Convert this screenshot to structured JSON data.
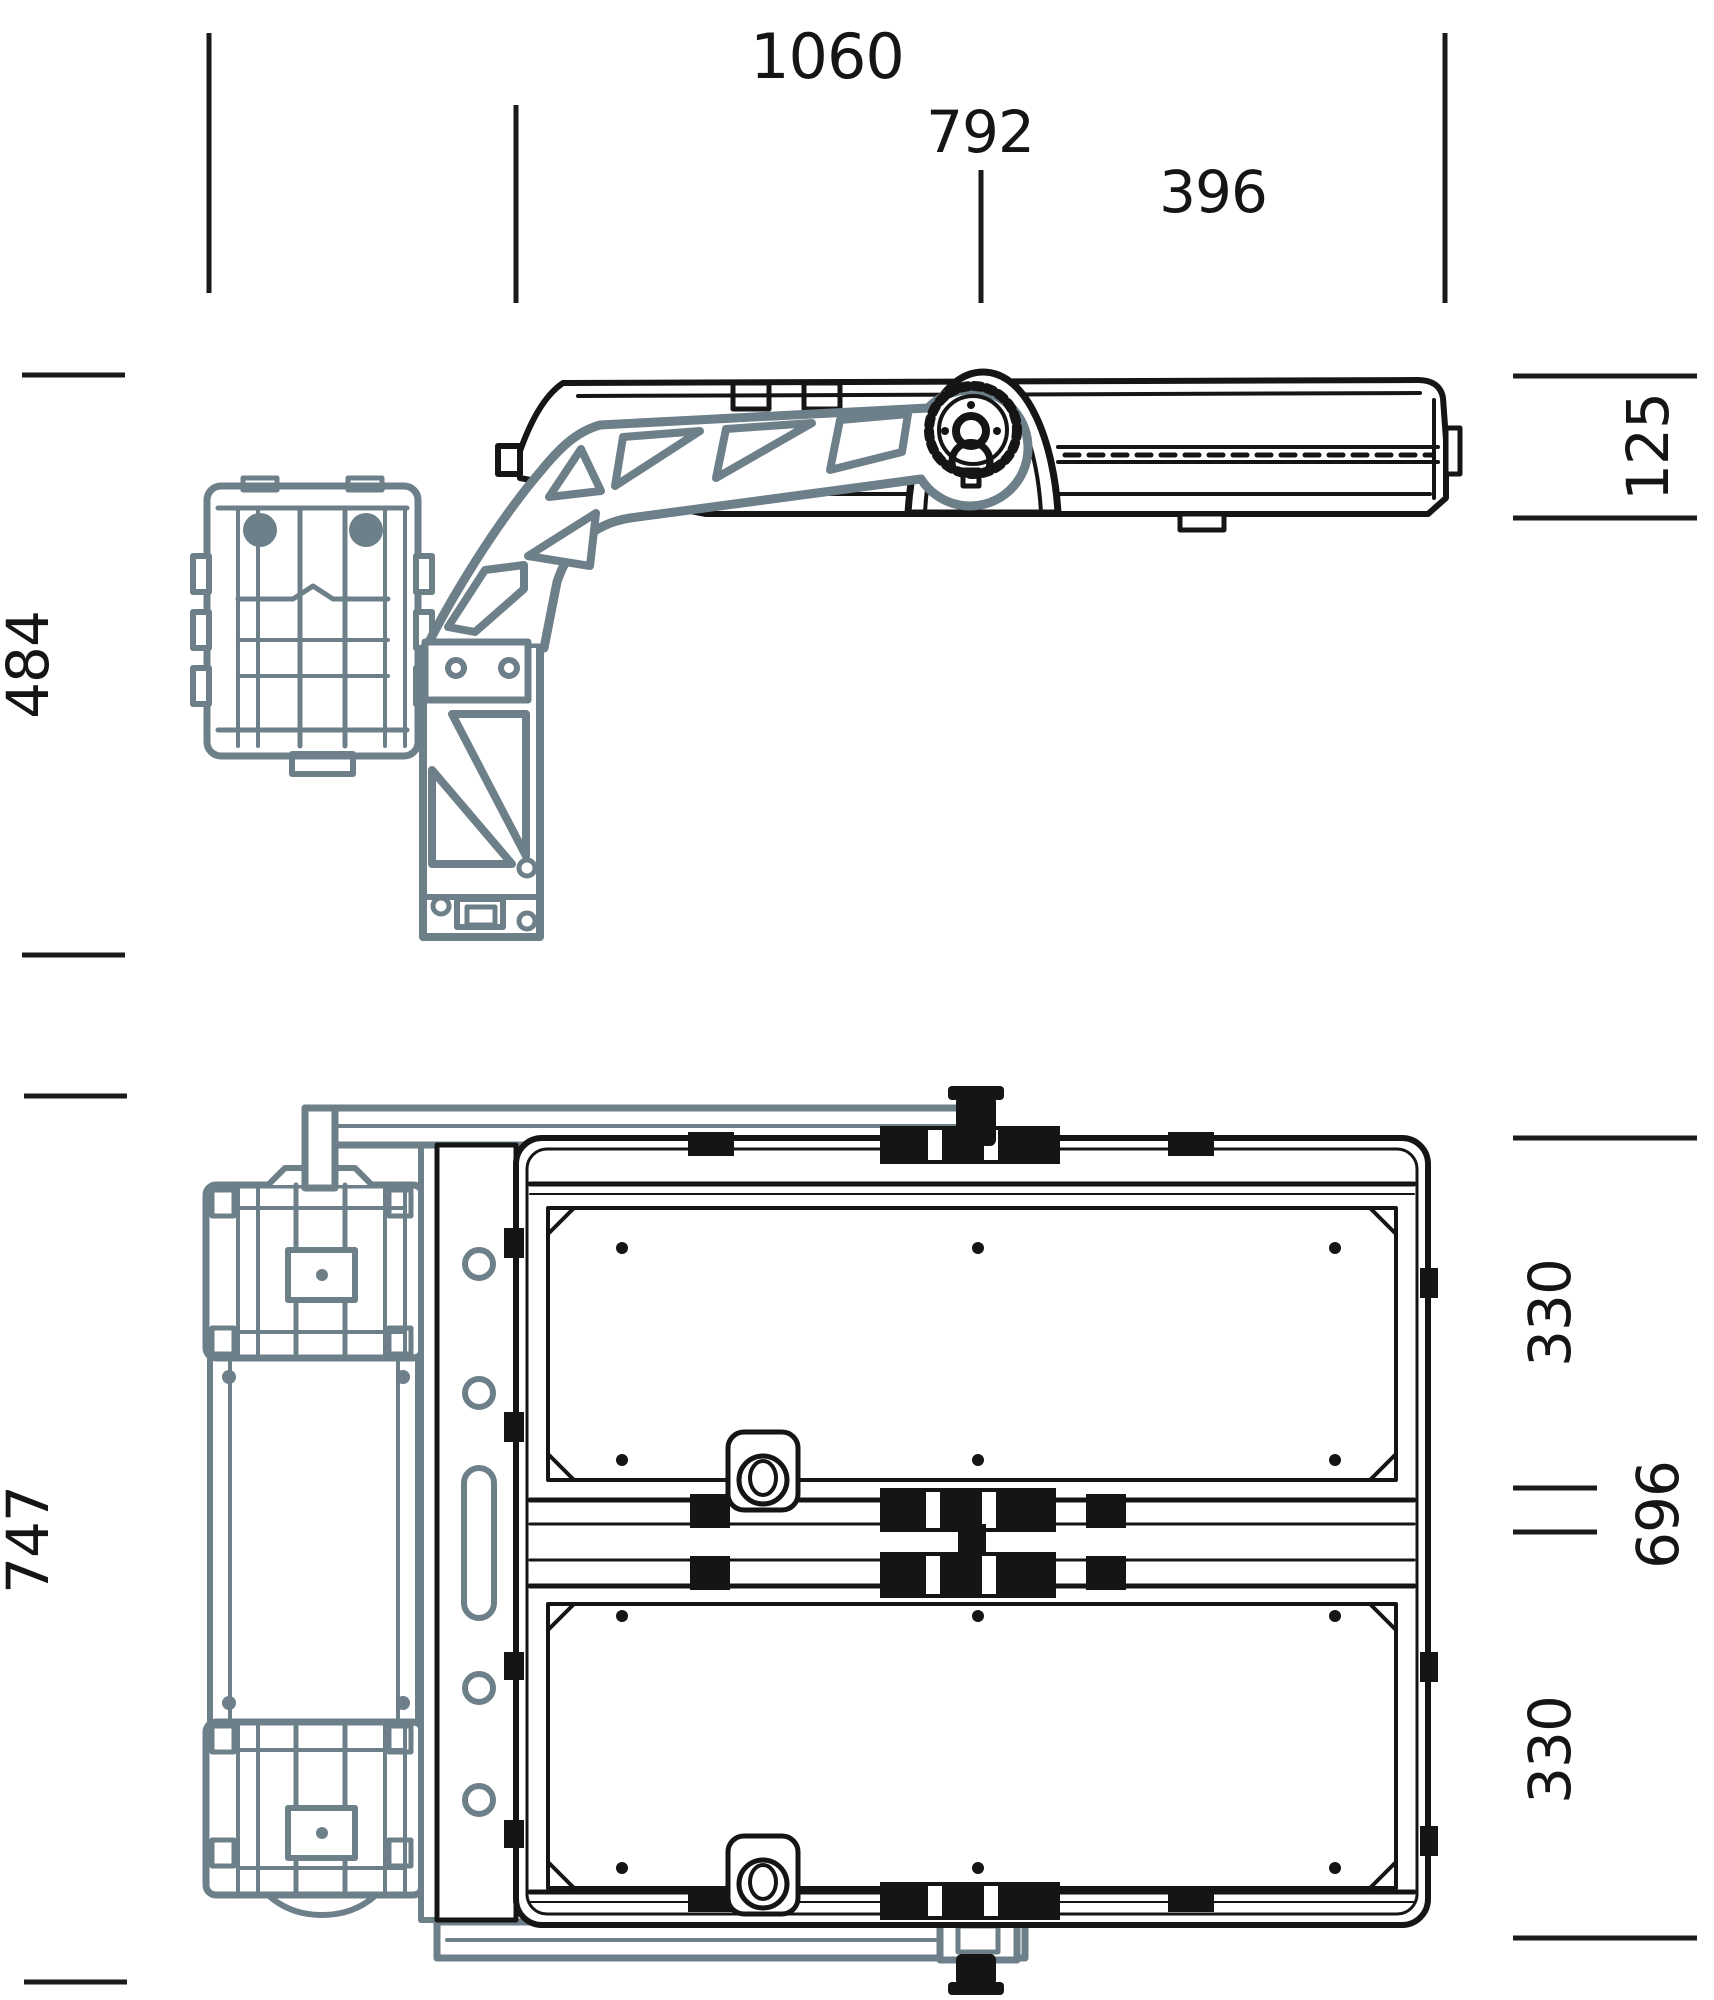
{
  "drawing": {
    "type": "technical-dimension-drawing",
    "views": {
      "top": "side-view-of-floodlight-with-mounting-arm",
      "bottom": "back-view-of-floodlight-with-pole-clamp"
    }
  },
  "colors": {
    "line_black": "#151515",
    "part_gray": "#6d7f88",
    "background": "#ffffff"
  },
  "dims": {
    "overall_width": "1060",
    "body_width": "792",
    "module_width": "396",
    "body_depth": "125",
    "arm_height": "484",
    "overall_height": "747",
    "top_module_height": "330",
    "body_height": "696",
    "bottom_module_height": "330"
  }
}
